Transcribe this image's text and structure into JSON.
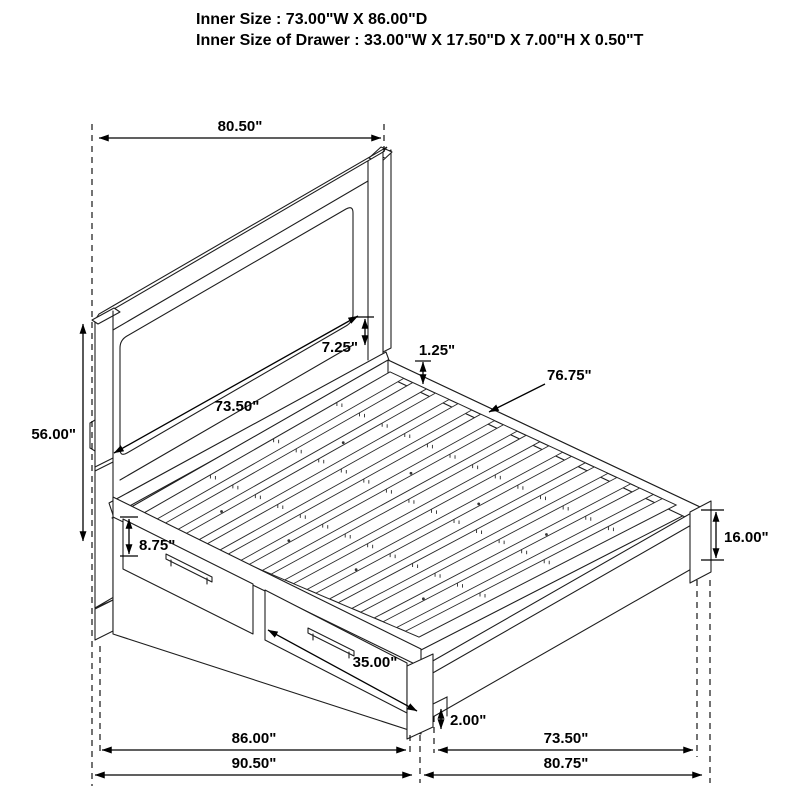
{
  "title": {
    "line1": "Inner Size : 73.00\"W X 86.00\"D",
    "line2": "Inner Size of Drawer : 33.00\"W X 17.50\"D X 7.00\"H X 0.50\"T"
  },
  "dims": {
    "width_overall": "80.50\"",
    "headboard_height": "56.00\"",
    "headboard_panel_width": "73.50\"",
    "panel_to_deck_gap": "7.25\"",
    "slat_thickness": "1.25\"",
    "slat_length": "76.75\"",
    "drawer_front_height": "8.75\"",
    "drawer_front_width": "35.00\"",
    "floor_clearance": "2.00\"",
    "footboard_height": "16.00\"",
    "side_inner_length": "86.00\"",
    "side_overall_length": "90.50\"",
    "foot_inner_width": "73.50\"",
    "foot_overall_width": "80.75\""
  },
  "colors": {
    "drawing_line": "#1e1e1e",
    "dimension_line": "#000000",
    "background": "#ffffff"
  }
}
